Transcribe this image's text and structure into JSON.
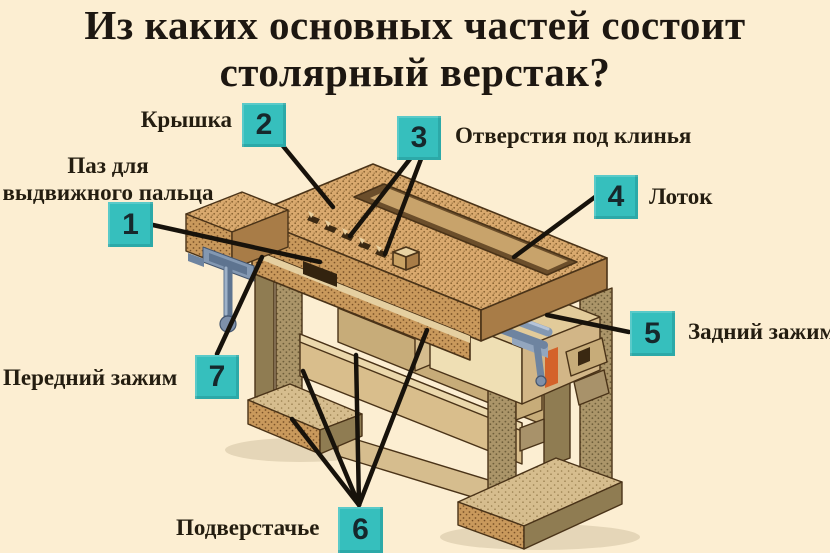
{
  "colors": {
    "background": "#FCEED2",
    "accent_box": "#36BFBD",
    "text": "#241d10",
    "leader_line": "#17120b"
  },
  "title": {
    "line1": "Из каких основных частей состоит",
    "line2": "столярный верстак?"
  },
  "callouts": {
    "groove": {
      "number": "1",
      "label": "Паз для выдвижного пальца"
    },
    "top": {
      "number": "2",
      "label": "Крышка"
    },
    "wedge_holes": {
      "number": "3",
      "label": "Отверстия под клинья"
    },
    "tray": {
      "number": "4",
      "label": "Лоток"
    },
    "rear_clamp": {
      "number": "5",
      "label": "Задний зажим"
    },
    "underframe": {
      "number": "6",
      "label": "Подверстачье"
    },
    "front_clamp": {
      "number": "7",
      "label": "Передний зажим"
    }
  }
}
